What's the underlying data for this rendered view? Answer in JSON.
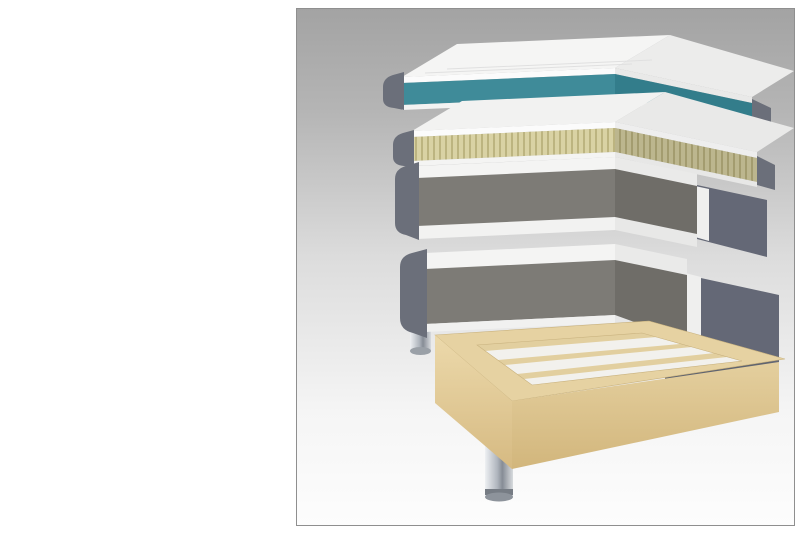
{
  "title": "No5",
  "subtitle": "Continental Bed",
  "fabric_swatches": [
    {
      "name": "Bell basic",
      "code": "MCD36",
      "colors": [
        "#efe9dc",
        "#cdc6b4"
      ]
    },
    {
      "name": "Bell basic",
      "code": "MCD32",
      "colors": [
        "#b8b4aa",
        "#8f8b80"
      ]
    },
    {
      "name": "Bell basic",
      "code": "MCD43",
      "colors": [
        "#6a6c70",
        "#46484c"
      ]
    },
    {
      "name": "Bell basic",
      "code": "MCD74",
      "colors": [
        "#474d66",
        "#2e3346"
      ]
    },
    {
      "name": "Roma",
      "code": "stretch fabric",
      "colors": [
        "#f3f3f3",
        "#f3f3f3"
      ]
    }
  ],
  "leg_options": [
    {
      "height": "16",
      "type": "cylinder-chrome"
    },
    {
      "height": "16",
      "type": "cylinder-brass"
    },
    {
      "height": "15",
      "type": "cross-gold"
    },
    {
      "height": "15",
      "type": "cross-silver"
    },
    {
      "height": "15",
      "type": "hairpin-gold"
    },
    {
      "height": "16",
      "type": "tapered-black-gold"
    }
  ],
  "features": [
    {
      "num": "1",
      "text": "Stretch fabric quilted with wadding."
    },
    {
      "num": "2",
      "text": "Top mattres option:",
      "sub": [
        "a.Watergel. 4cm.",
        "b.Latex. 4cm."
      ]
    },
    {
      "num": "3",
      "text": "Fabric."
    },
    {
      "num": "4",
      "text": "HR foam 30kg. 3cm."
    },
    {
      "num": "5",
      "text": "Micropocket. Height 15 cm. 7zones. Option:",
      "sub": [
        "a. Firm/ firm",
        "b. Medium/ medium",
        "c. Firm/ medium"
      ]
    },
    {
      "num": "6",
      "text": "Polyurethane foam 25kg. 2cm."
    },
    {
      "num": "7",
      "text": "Pocket. Height 13cm."
    },
    {
      "num": "8",
      "text": "Pocket. Height 10cm."
    },
    {
      "num": "9",
      "text": "Wood."
    },
    {
      "num": "10",
      "text": "Metal leg. Height 16cm."
    }
  ],
  "diagram": {
    "ruler_labels": [
      "6",
      "6",
      "21 cm",
      "27 cm",
      "16 cm"
    ],
    "badges": [
      {
        "label": "3",
        "x": 95,
        "y": 70,
        "shape": "circle"
      },
      {
        "label": "2a",
        "x": 182,
        "y": 80,
        "shape": "plain"
      },
      {
        "label": "1",
        "x": 400,
        "y": 57,
        "shape": "circle"
      },
      {
        "label": "3",
        "x": 103,
        "y": 124,
        "shape": "circle"
      },
      {
        "label": "2b",
        "x": 185,
        "y": 133,
        "shape": "ellipse"
      },
      {
        "label": "1",
        "x": 403,
        "y": 122,
        "shape": "circle"
      },
      {
        "label": "4",
        "x": 220,
        "y": 160,
        "shape": "circle"
      },
      {
        "label": "5",
        "x": 264,
        "y": 183,
        "shape": "circle"
      },
      {
        "label": "4",
        "x": 223,
        "y": 212,
        "shape": "circle"
      },
      {
        "label": "3",
        "x": 107,
        "y": 184,
        "shape": "circle"
      },
      {
        "label": "6",
        "x": 225,
        "y": 241,
        "shape": "circle"
      },
      {
        "label": "7",
        "x": 256,
        "y": 261,
        "shape": "circle"
      },
      {
        "label": "3",
        "x": 119,
        "y": 268,
        "shape": "circle"
      },
      {
        "label": "8",
        "x": 257,
        "y": 298,
        "shape": "circle"
      },
      {
        "label": "9",
        "x": 170,
        "y": 352,
        "shape": "circle"
      },
      {
        "label": "10",
        "x": 183,
        "y": 462,
        "shape": "circle"
      }
    ],
    "firmness_table": [
      {
        "label": "5a",
        "cells": [
          {
            "text": "F",
            "variant": "dark"
          },
          {
            "text": "F",
            "variant": "dark"
          }
        ]
      },
      {
        "label": "5b",
        "cells": [
          {
            "text": "M",
            "variant": "light"
          },
          {
            "text": "M",
            "variant": "light"
          }
        ]
      },
      {
        "label": "5c",
        "cells": [
          {
            "text": "F",
            "variant": "dark"
          },
          {
            "text": "M",
            "variant": "light"
          }
        ]
      }
    ],
    "version": "2022.04",
    "colors": {
      "badge": "#2e6f6a",
      "topper_core": "#3f8b99",
      "latex": "#d9d2a4",
      "fabric_side": "#6b6f7a",
      "wood": "#e6d2a2"
    }
  }
}
